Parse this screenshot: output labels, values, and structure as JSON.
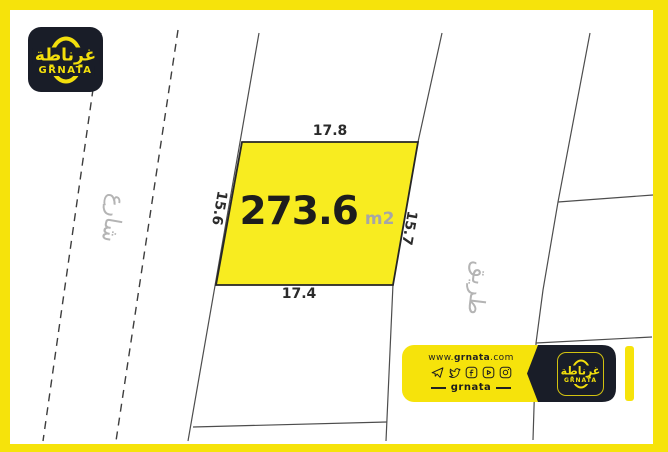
{
  "brand": {
    "name": "GRNATA",
    "arabic_name": "غرناطة",
    "colors": {
      "yellow": "#F6E30B",
      "plot_yellow": "#F8EC20",
      "black": "#191D28"
    }
  },
  "plot": {
    "area_value": "273.6",
    "area_unit": "m2",
    "dim_top": "17.8",
    "dim_bottom": "17.4",
    "dim_left": "15.6",
    "dim_right": "15.7"
  },
  "labels": {
    "street_left": "شارع",
    "road_right": "طريق"
  },
  "footer": {
    "website_prefix": "www.",
    "website_name": "grnata",
    "website_suffix": ".com",
    "handle": "grnata",
    "icons": [
      "telegram-icon",
      "twitter-icon",
      "facebook-icon",
      "youtube-icon",
      "instagram-icon"
    ]
  }
}
